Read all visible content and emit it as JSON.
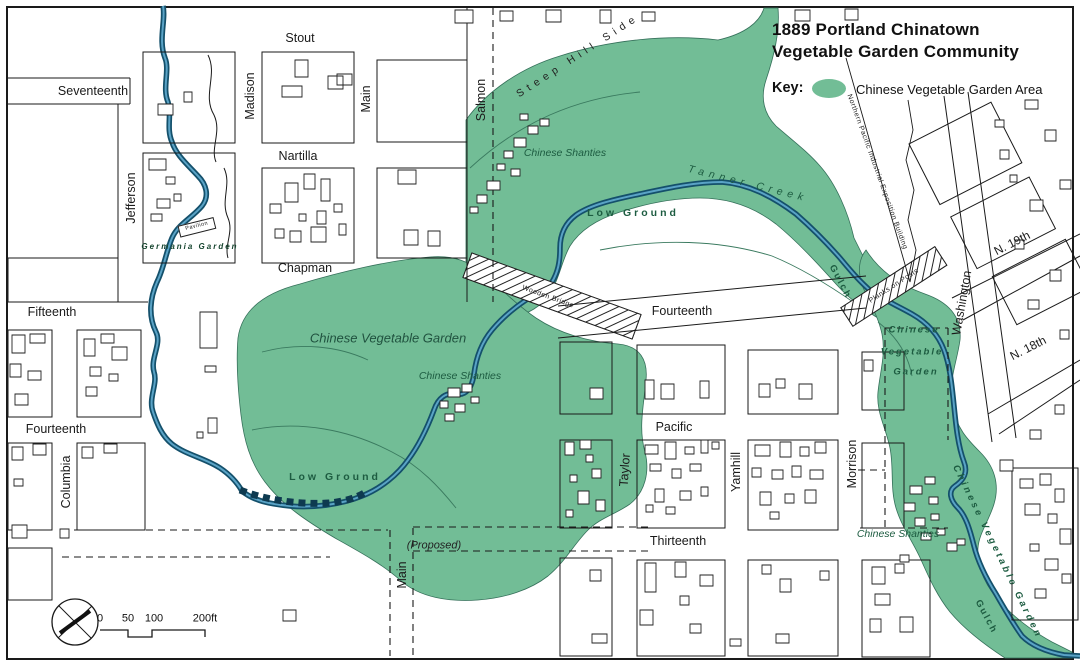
{
  "header": {
    "title_line1": "1889 Portland Chinatown",
    "title_line2": "Vegetable Garden Community",
    "key_label": "Key:",
    "key_item": "Chinese Vegetable Garden Area"
  },
  "colors": {
    "garden_green": "#72bd96",
    "creek_dark": "#14506b",
    "creek_light": "#5aa3c6",
    "map_line": "#1a1a1a",
    "feature_label_green": "#1d5c41"
  },
  "streets": {
    "seventeenth": "Seventeenth",
    "stout": "Stout",
    "madison": "Madison",
    "main_top": "Main",
    "nartilla": "Nartilla",
    "jefferson": "Jefferson",
    "chapman": "Chapman",
    "salmon": "Salmon",
    "fifteenth": "Fifteenth",
    "fourteenth_left": "Fourteenth",
    "fourteenth_center": "Fourteenth",
    "columbia": "Columbia",
    "pacific": "Pacific",
    "taylor": "Taylor",
    "yamhill": "Yamhill",
    "morrison": "Morrison",
    "thirteenth": "Thirteenth",
    "main_proposed": "Main",
    "washington": "Washington",
    "n_19th": "N. 19th",
    "n_18th": "N. 18th"
  },
  "features": {
    "steep_hill_side": "Steep Hill Side",
    "tanner_creek": "Tanner Creek",
    "low_ground_upper": "Low Ground",
    "low_ground_lower": "Low Ground",
    "gulch_upper": "Gulch",
    "gulch_lower": "Gulch",
    "chinese_shanties_top": "Chinese Shanties",
    "chinese_shanties_center": "Chinese Shanties",
    "chinese_shanties_bottom": "Chinese Shanties",
    "chinese_vegetable_garden": "Chinese Vegetable Garden",
    "cvg_right_line1": "Chinese",
    "cvg_right_line2": "Vegetable",
    "cvg_right_line3": "Garden",
    "cvg_diagonal": "Chinese Vegetable Garden",
    "germania_garden": "Germania Garden",
    "pavilion": "Pavilion",
    "wooden_bridge": "Wooden Bridge",
    "planks_on_posts": "Planks on Posts",
    "proposed": "(Proposed)",
    "exposition_building": "Northern Pacific Industrial Exposition Building"
  },
  "scale_bar": {
    "t0": "0",
    "t50": "50",
    "t100": "100",
    "t200": "200ft"
  }
}
